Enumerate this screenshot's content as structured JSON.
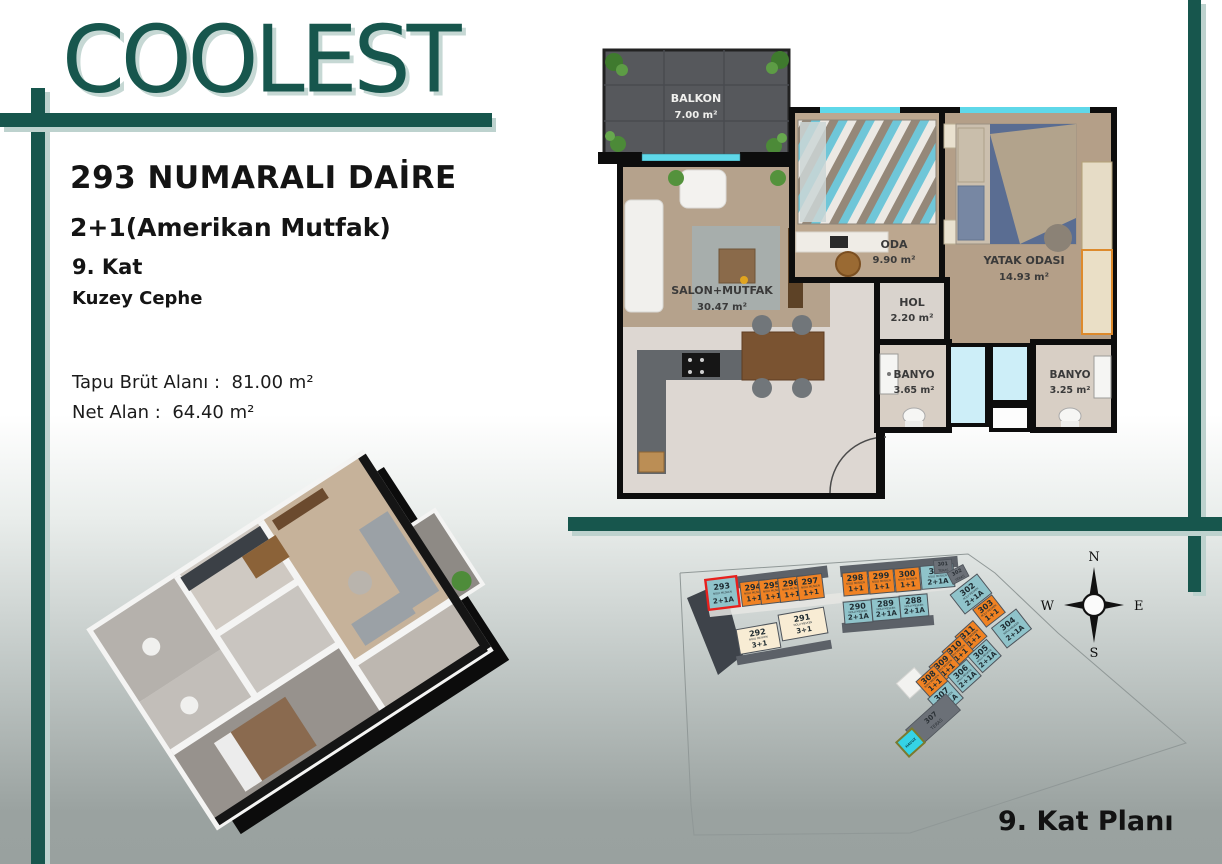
{
  "logo": {
    "text": "COOLEST"
  },
  "info": {
    "title": "293 NUMARALI DAİRE",
    "type": "2+1(Amerikan Mutfak)",
    "floor": "9. Kat",
    "facade": "Kuzey Cephe",
    "gross_label": "Tapu Brüt Alanı :",
    "gross_value": "81.00 m²",
    "net_label": "Net Alan :",
    "net_value": "64.40 m²"
  },
  "colors": {
    "accent": "#17564d",
    "accent_shadow": "#bdd2ce",
    "highlight": "#e8201d",
    "window_cyan": "#5fd8e9"
  },
  "floor_plan": {
    "rooms": [
      {
        "name": "BALKON",
        "area": "7.00 m²"
      },
      {
        "name": "SALON+MUTFAK",
        "area": "30.47 m²"
      },
      {
        "name": "ODA",
        "area": "9.90 m²"
      },
      {
        "name": "YATAK ODASI",
        "area": "14.93 m²"
      },
      {
        "name": "HOL",
        "area": "2.20 m²"
      },
      {
        "name": "BANYO",
        "area": "3.65 m²"
      },
      {
        "name": "BANYO",
        "area": "3.25 m²"
      }
    ]
  },
  "site_plan": {
    "title": "9. Kat Planı",
    "unit_sublabel": "NOLU MESKEN",
    "teras_label": "TERAS",
    "pool_label": "HAVUZ",
    "compass": {
      "n": "N",
      "e": "E",
      "s": "S",
      "w": "W"
    },
    "colors": {
      "orange": "#f08223",
      "teal": "#8fc3ca",
      "cream": "#f8ecd4",
      "roof": "#5c6168",
      "teras": "#6b7077",
      "building": "#3e434a",
      "pool": "#35d3e6"
    },
    "units": [
      {
        "id": "293",
        "type": "2+1A",
        "color": "teal",
        "highlighted": true
      },
      {
        "id": "294",
        "type": "1+1",
        "color": "orange",
        "highlighted": false
      },
      {
        "id": "295",
        "type": "1+1",
        "color": "orange",
        "highlighted": false
      },
      {
        "id": "296",
        "type": "1+1",
        "color": "orange",
        "highlighted": false
      },
      {
        "id": "297",
        "type": "1+1",
        "color": "orange",
        "highlighted": false
      },
      {
        "id": "298",
        "type": "1+1",
        "color": "orange",
        "highlighted": false
      },
      {
        "id": "299",
        "type": "1+1",
        "color": "orange",
        "highlighted": false
      },
      {
        "id": "300",
        "type": "1+1",
        "color": "orange",
        "highlighted": false
      },
      {
        "id": "301",
        "type": "2+1A",
        "color": "teal",
        "highlighted": false
      },
      {
        "id": "290",
        "type": "2+1A",
        "color": "teal",
        "highlighted": false
      },
      {
        "id": "289",
        "type": "2+1A",
        "color": "teal",
        "highlighted": false
      },
      {
        "id": "288",
        "type": "2+1A",
        "color": "teal",
        "highlighted": false
      },
      {
        "id": "292",
        "type": "3+1",
        "color": "cream",
        "highlighted": false
      },
      {
        "id": "291",
        "type": "3+1",
        "color": "cream",
        "highlighted": false
      },
      {
        "id": "302",
        "type": "2+1A",
        "color": "teal",
        "highlighted": false
      },
      {
        "id": "303",
        "type": "1+1",
        "color": "orange",
        "highlighted": false
      },
      {
        "id": "304",
        "type": "2+1A",
        "color": "teal",
        "highlighted": false
      },
      {
        "id": "311",
        "type": "1+1",
        "color": "orange",
        "highlighted": false
      },
      {
        "id": "310",
        "type": "1+1",
        "color": "orange",
        "highlighted": false
      },
      {
        "id": "309",
        "type": "1+1",
        "color": "orange",
        "highlighted": false
      },
      {
        "id": "308",
        "type": "1+1",
        "color": "orange",
        "highlighted": false
      },
      {
        "id": "305",
        "type": "2+1A",
        "color": "teal",
        "highlighted": false
      },
      {
        "id": "306",
        "type": "2+1A",
        "color": "teal",
        "highlighted": false
      },
      {
        "id": "307",
        "type": "2+1A",
        "color": "teal",
        "highlighted": false
      }
    ],
    "teras_blocks": [
      {
        "id": "301",
        "label": "TERAS"
      },
      {
        "id": "302",
        "label": "TERAS"
      },
      {
        "id": "307",
        "label": "TERAS"
      }
    ]
  }
}
